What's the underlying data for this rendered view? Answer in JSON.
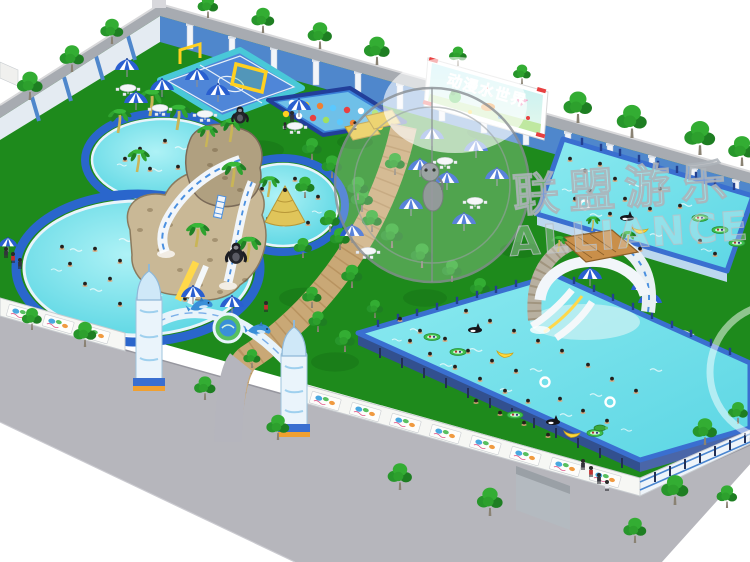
{
  "scene": {
    "billboard": {
      "text": "动漫水世界"
    },
    "watermark": {
      "cn": "联盟游乐",
      "en": "ALLIANCE"
    },
    "legend": {
      "tree": "tree-icon",
      "palm": "palm-tree-icon",
      "umbrella": "beach-umbrella-icon",
      "table": "picnic-table-icon",
      "swimmer": "swimmer-icon",
      "person": "person-icon",
      "banana_float": "banana-float-icon",
      "orca_float": "orca-float-icon",
      "boat_float": "raft-float-icon",
      "swim_ring": "swim-ring-icon",
      "turtle_float": "turtle-float-icon",
      "gorilla": "gorilla-figure-icon",
      "dolphin": "dolphin-figure-icon"
    }
  },
  "colors": {
    "bg": "#ffffff",
    "lawn": "#1e8a1c",
    "lawn_dark": "#0e5c10",
    "road": "#b6b6bc",
    "road_edge": "#97979f",
    "wall_cap": "#a7abb1",
    "wall_face_blue": "#4f87cc",
    "wall_face_white": "#e4ebf2",
    "pillar": "#f2f5f9",
    "pool_ring": "#2a66cc",
    "water_hi": "#a8f0f4",
    "water": "#5cd6e4",
    "frame_rim": "#3a6fd0",
    "frame_wall": "#32508f",
    "fence_white": "#f6f7f4",
    "path_tan": "#c9a876",
    "path_line": "#a9824f",
    "walkway": "#b5b5bd",
    "umbrella_blue": "#2a5fd0",
    "billboard_text": "#e83030",
    "goal_yellow": "#ffd020",
    "sand": "#e0c55a",
    "slide_white": "#f2f6fa",
    "stone": "#c9b896",
    "roof_brown": "#c98f4a"
  }
}
